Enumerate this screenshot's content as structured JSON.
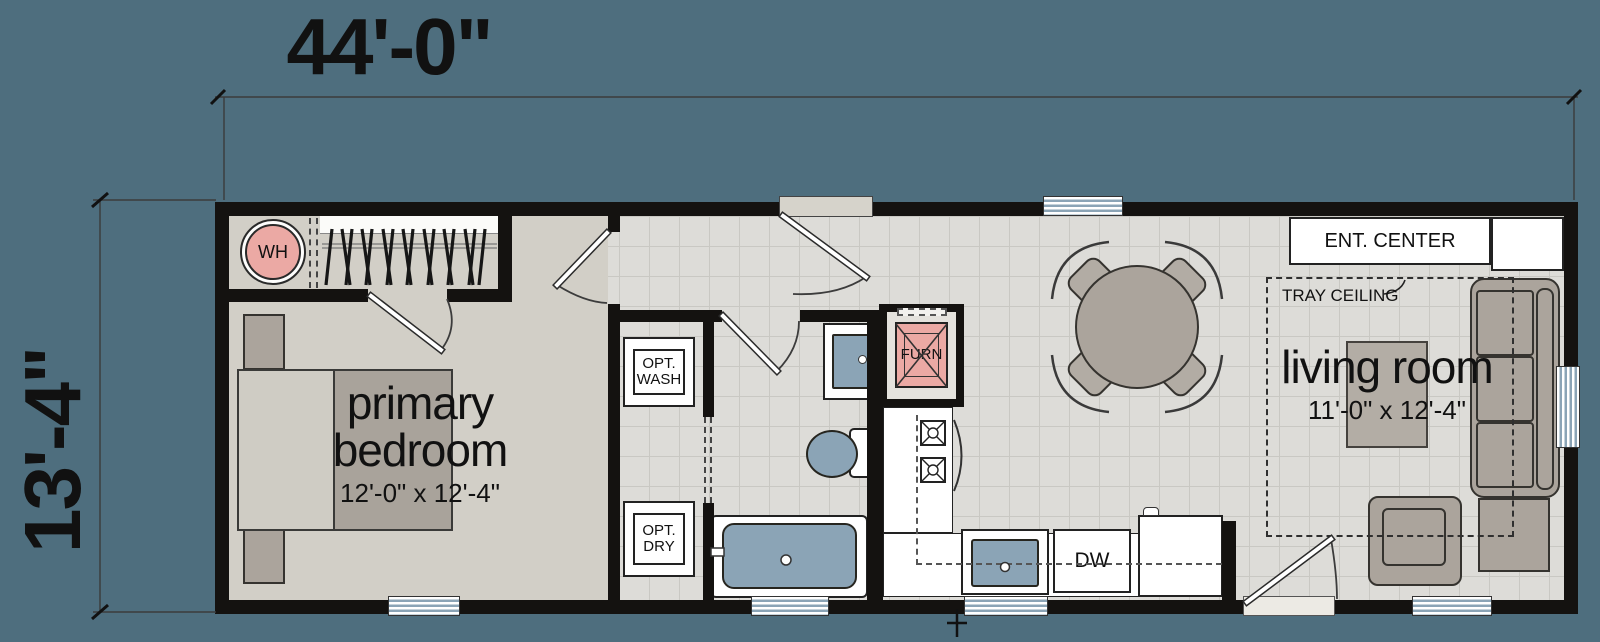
{
  "dimensions": {
    "width": "44'-0\"",
    "height": "13'-4\""
  },
  "rooms": {
    "primary_bedroom": {
      "name_line1": "primary",
      "name_line2": "bedroom",
      "size": "12'-0\" x 12'-4\""
    },
    "living_room": {
      "name": "living room",
      "size": "11'-0\" x 12'-4\""
    }
  },
  "fixtures": {
    "water_heater": "WH",
    "furnace": "FURN",
    "washer_line1": "OPT.",
    "washer_line2": "WASH",
    "dryer_line1": "OPT.",
    "dryer_line2": "DRY",
    "dishwasher": "DW",
    "ent_center": "ENT. CENTER",
    "tray_ceiling": "TRAY CEILING"
  },
  "colors": {
    "background": "#4e6e7e",
    "wall": "#141210",
    "carpet": "#d2cfc7",
    "tile": "#dddcd8",
    "tile_line": "#c9c8c3",
    "furniture": "#aba49c",
    "furniture_dark": "#35332f",
    "fixture_blue": "#8ba4b6",
    "accent_pink": "#eba9a4",
    "paper": "#ffffff"
  }
}
